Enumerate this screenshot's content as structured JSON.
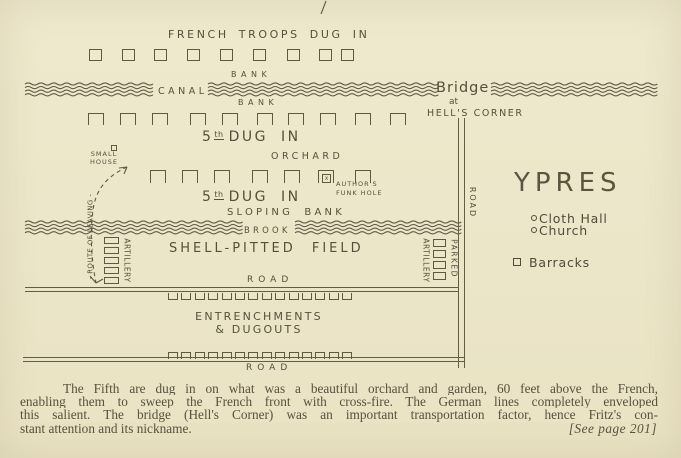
{
  "page": {
    "bg": "#ece6c9",
    "ink": "#5f5944",
    "caption_ink": "#57513e"
  },
  "map": {
    "top_label": "FRENCH TROOPS DUG IN",
    "bank_upper": "BANK",
    "canal_label": "CANAL",
    "bank_lower": "BANK",
    "bridge": {
      "line1": "Bridge",
      "line2": "at",
      "line3": "HELL'S CORNER"
    },
    "dug_in_1": {
      "num": "5",
      "sup": "th",
      "rest": "DUG IN"
    },
    "orchard": "ORCHARD",
    "small_house": "SMALL HOUSE",
    "route_of_leaving": "- ROUTE OF LEAVING -",
    "dug_in_2": {
      "num": "5",
      "sup": "th",
      "rest": "DUG IN"
    },
    "authors_funk_hole": {
      "line1": "AUTHOR'S",
      "line2": "FUNK HOLE",
      "mark": "x"
    },
    "sloping_bank": "SLOPING BANK",
    "brook_label": "BROOK",
    "artillery_left": "ARTILLERY",
    "shell_pitted_field": "SHELL-PITTED FIELD",
    "artillery_right": "ARTILLERY",
    "parked": "PARKED",
    "road_mid": "ROAD",
    "entrenchments_line1": "ENTRENCHMENTS",
    "entrenchments_line2": "& DUGOUTS",
    "road_bottom": "ROAD",
    "road_right": "ROAD"
  },
  "legend": {
    "city": "YPRES",
    "items": [
      {
        "symbol": "circle",
        "label": "Cloth Hall"
      },
      {
        "symbol": "circle",
        "label": "Church"
      },
      {
        "symbol": "square",
        "label": "Barracks"
      }
    ]
  },
  "caption": {
    "lines": [
      "The Fifth are dug in on what was a beautiful orchard and garden, 60 feet above the French,",
      "enabling them to sweep the French front with cross-fire.  The German lines completely enveloped",
      "this salient.  The bridge (Hell's Corner) was an important transportation factor, hence Fritz's con-",
      "stant attention and its nickname."
    ],
    "page_ref": "[See page 201]"
  },
  "geometry": {
    "rows": [
      {
        "name": "french-dugout-row",
        "style": "box",
        "y": 49,
        "w": 13,
        "h": 12,
        "xs": [
          89,
          122,
          154,
          187,
          220,
          253,
          287,
          319,
          341
        ]
      },
      {
        "name": "fifth-dugout-row-1",
        "style": "open-bottom",
        "y": 113,
        "w": 16,
        "h": 12,
        "xs": [
          88,
          120,
          152,
          190,
          222,
          257,
          288,
          320,
          355,
          390
        ]
      },
      {
        "name": "fifth-dugout-row-2",
        "style": "open-bottom",
        "y": 170,
        "w": 16,
        "h": 13,
        "xs": [
          150,
          182,
          214,
          252,
          284,
          355
        ]
      },
      {
        "name": "entrenchment-row-upper",
        "style": "open-top",
        "y": 293,
        "w": 10,
        "h": 7,
        "x_start": 168,
        "spacing": 13.4,
        "count": 14
      },
      {
        "name": "entrenchment-row-lower",
        "style": "open-bottom",
        "y": 352,
        "w": 10,
        "h": 7,
        "x_start": 168,
        "spacing": 13.4,
        "count": 14
      },
      {
        "name": "artillery-left-stack",
        "style": "box",
        "x": 104,
        "w": 15,
        "h": 7,
        "ys": [
          237,
          247,
          257,
          267,
          277
        ]
      },
      {
        "name": "artillery-right-stack",
        "style": "box",
        "x": 433,
        "w": 13,
        "h": 8,
        "ys": [
          239,
          250,
          261,
          272
        ]
      }
    ],
    "waves": [
      {
        "name": "canal-waves",
        "y": 84,
        "count": 4,
        "dy": 3.6,
        "segments": [
          [
            25,
            156
          ],
          [
            208,
            436
          ],
          [
            491,
            655
          ]
        ]
      },
      {
        "name": "brook-waves",
        "y": 222,
        "count": 4,
        "dy": 3.6,
        "segments": [
          [
            25,
            241
          ],
          [
            295,
            458
          ]
        ]
      }
    ],
    "route": {
      "path": "M127,167 C108,176 96,188 93,210 C90,232 91,258 96,283",
      "arrows": [
        "M96,283 l-6,-7",
        "M96,283 l7,-4",
        "M127,167 l-8,1",
        "M127,167 l-3,7"
      ]
    },
    "stray_mark": "M326,1 L321,14"
  }
}
